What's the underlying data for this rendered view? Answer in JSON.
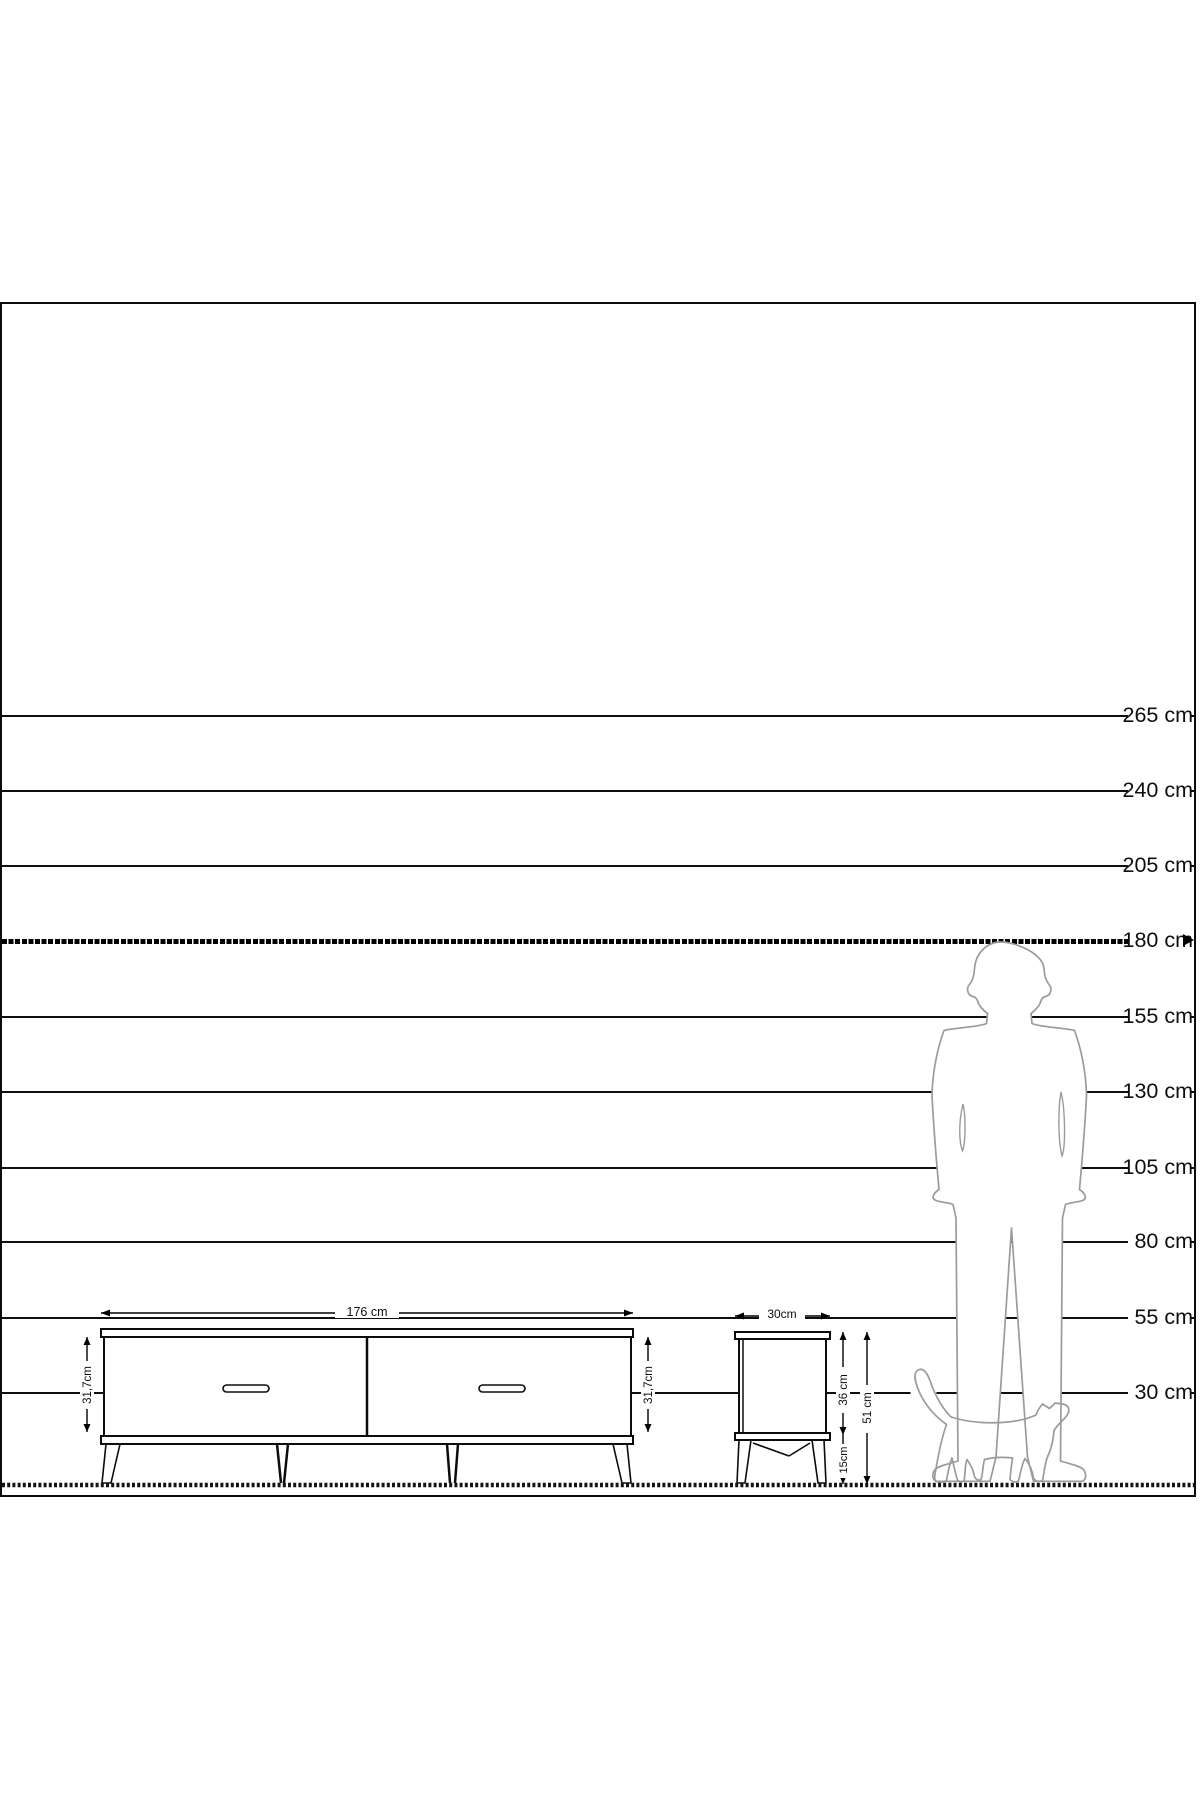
{
  "scale": {
    "unit": "cm",
    "labels": [
      "265 cm",
      "240 cm",
      "205 cm",
      "180 cm",
      "155 cm",
      "130 cm",
      "105 cm",
      "80 cm",
      "55 cm",
      "30 cm"
    ],
    "values": [
      265,
      240,
      205,
      180,
      155,
      130,
      105,
      80,
      55,
      30
    ],
    "highlighted_value": 180
  },
  "dimensions": {
    "tv_width": "176 cm",
    "tv_body_height_left": "31,7cm",
    "tv_body_height_right": "31,7cm",
    "table_width": "30cm",
    "table_body_height": "36 cm",
    "table_leg_height": "15cm",
    "table_total_height": "51 cm"
  },
  "figures": {
    "person": "standing man silhouette",
    "cat": "walking cat silhouette"
  },
  "colors": {
    "ink": "#0e0e0e",
    "silhouette": "#9b9b9b",
    "background": "#ffffff"
  }
}
